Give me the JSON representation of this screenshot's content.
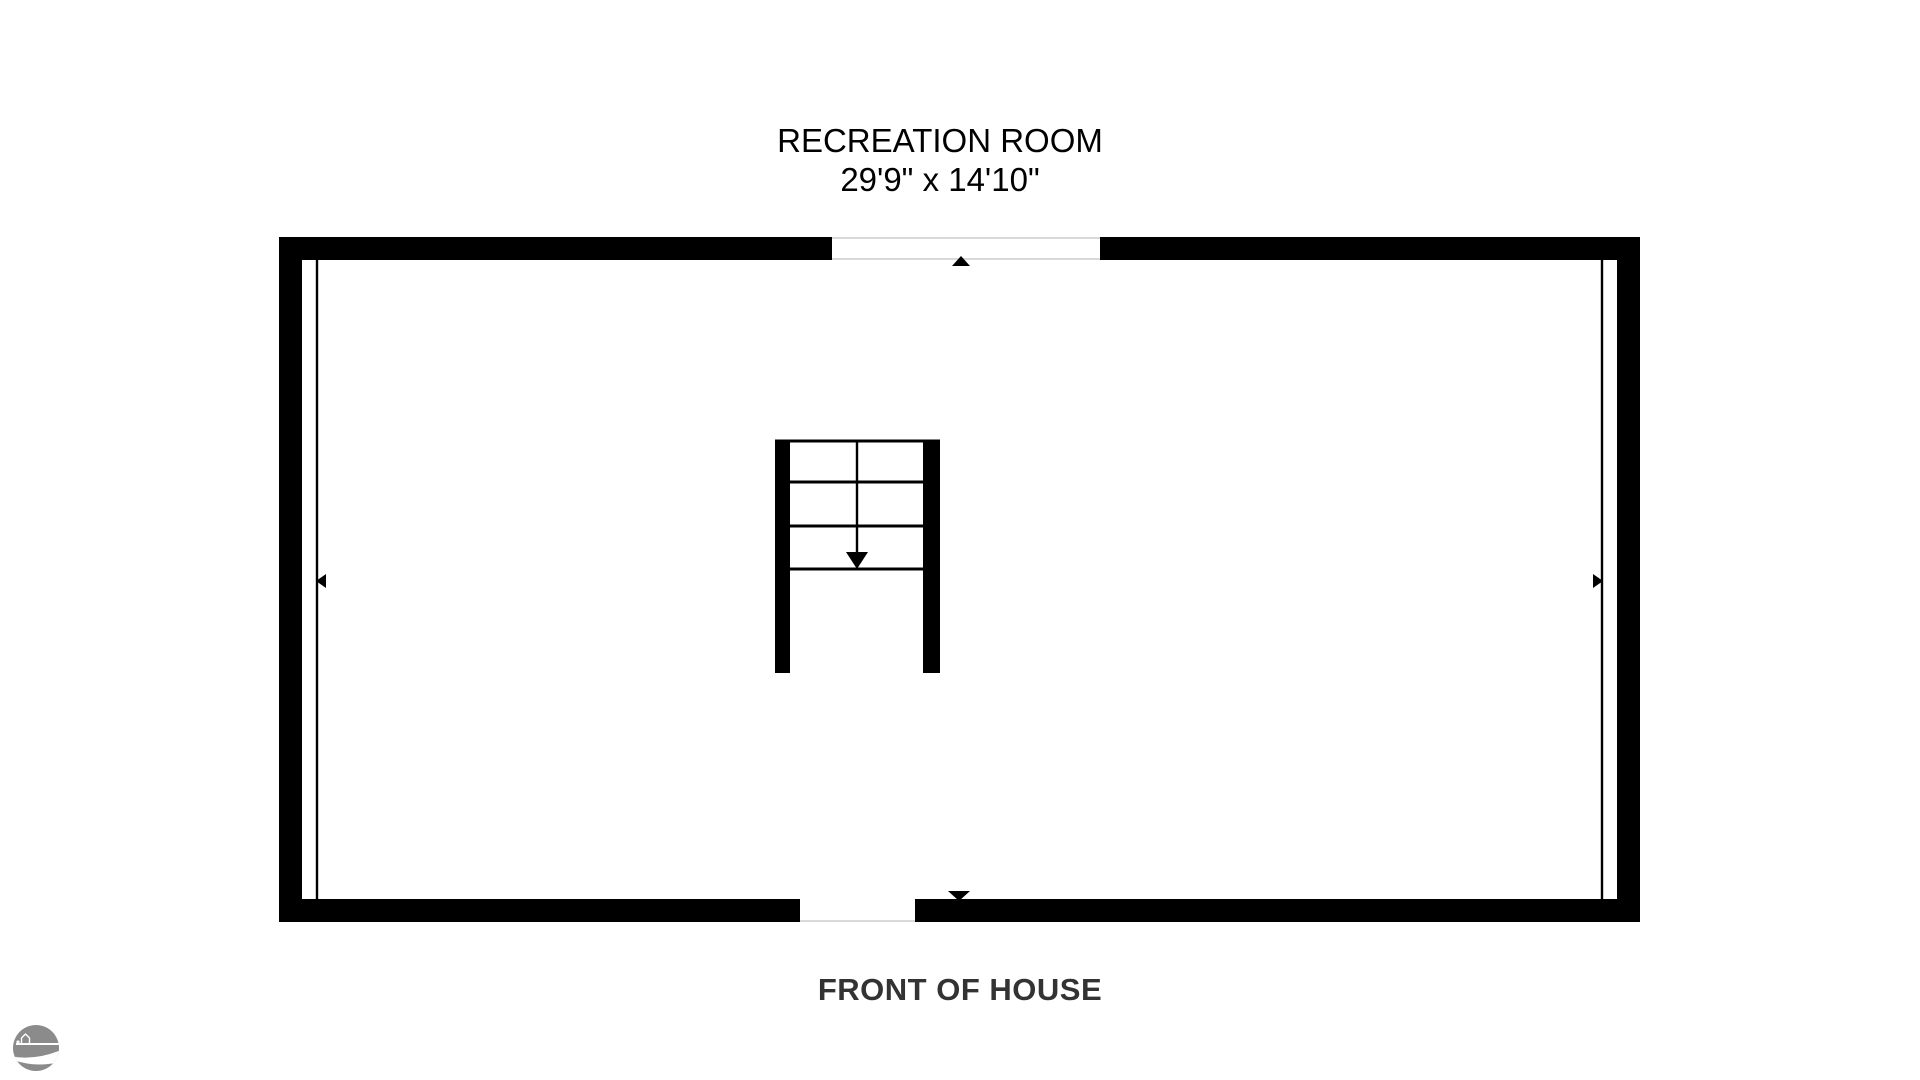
{
  "page": {
    "background": "#ffffff"
  },
  "floorplan": {
    "room": {
      "name": "RECREATION ROOM",
      "dimensions": "29'9\" x 14'10\""
    },
    "front_label": "FRONT OF HOUSE",
    "colors": {
      "wall": "#000000",
      "title_text": "#000000",
      "front_text": "#333333",
      "opening_line": "#d9d9d9",
      "logo_gray": "#8b8b8b"
    },
    "icons": {
      "logo": "house-road-logo",
      "top_marker": "up-arrow-icon",
      "bottom_marker": "down-arrow-icon",
      "left_marker": "left-arrow-icon",
      "right_marker": "right-arrow-icon",
      "stair_marker": "stairs-down-arrow-icon"
    }
  }
}
